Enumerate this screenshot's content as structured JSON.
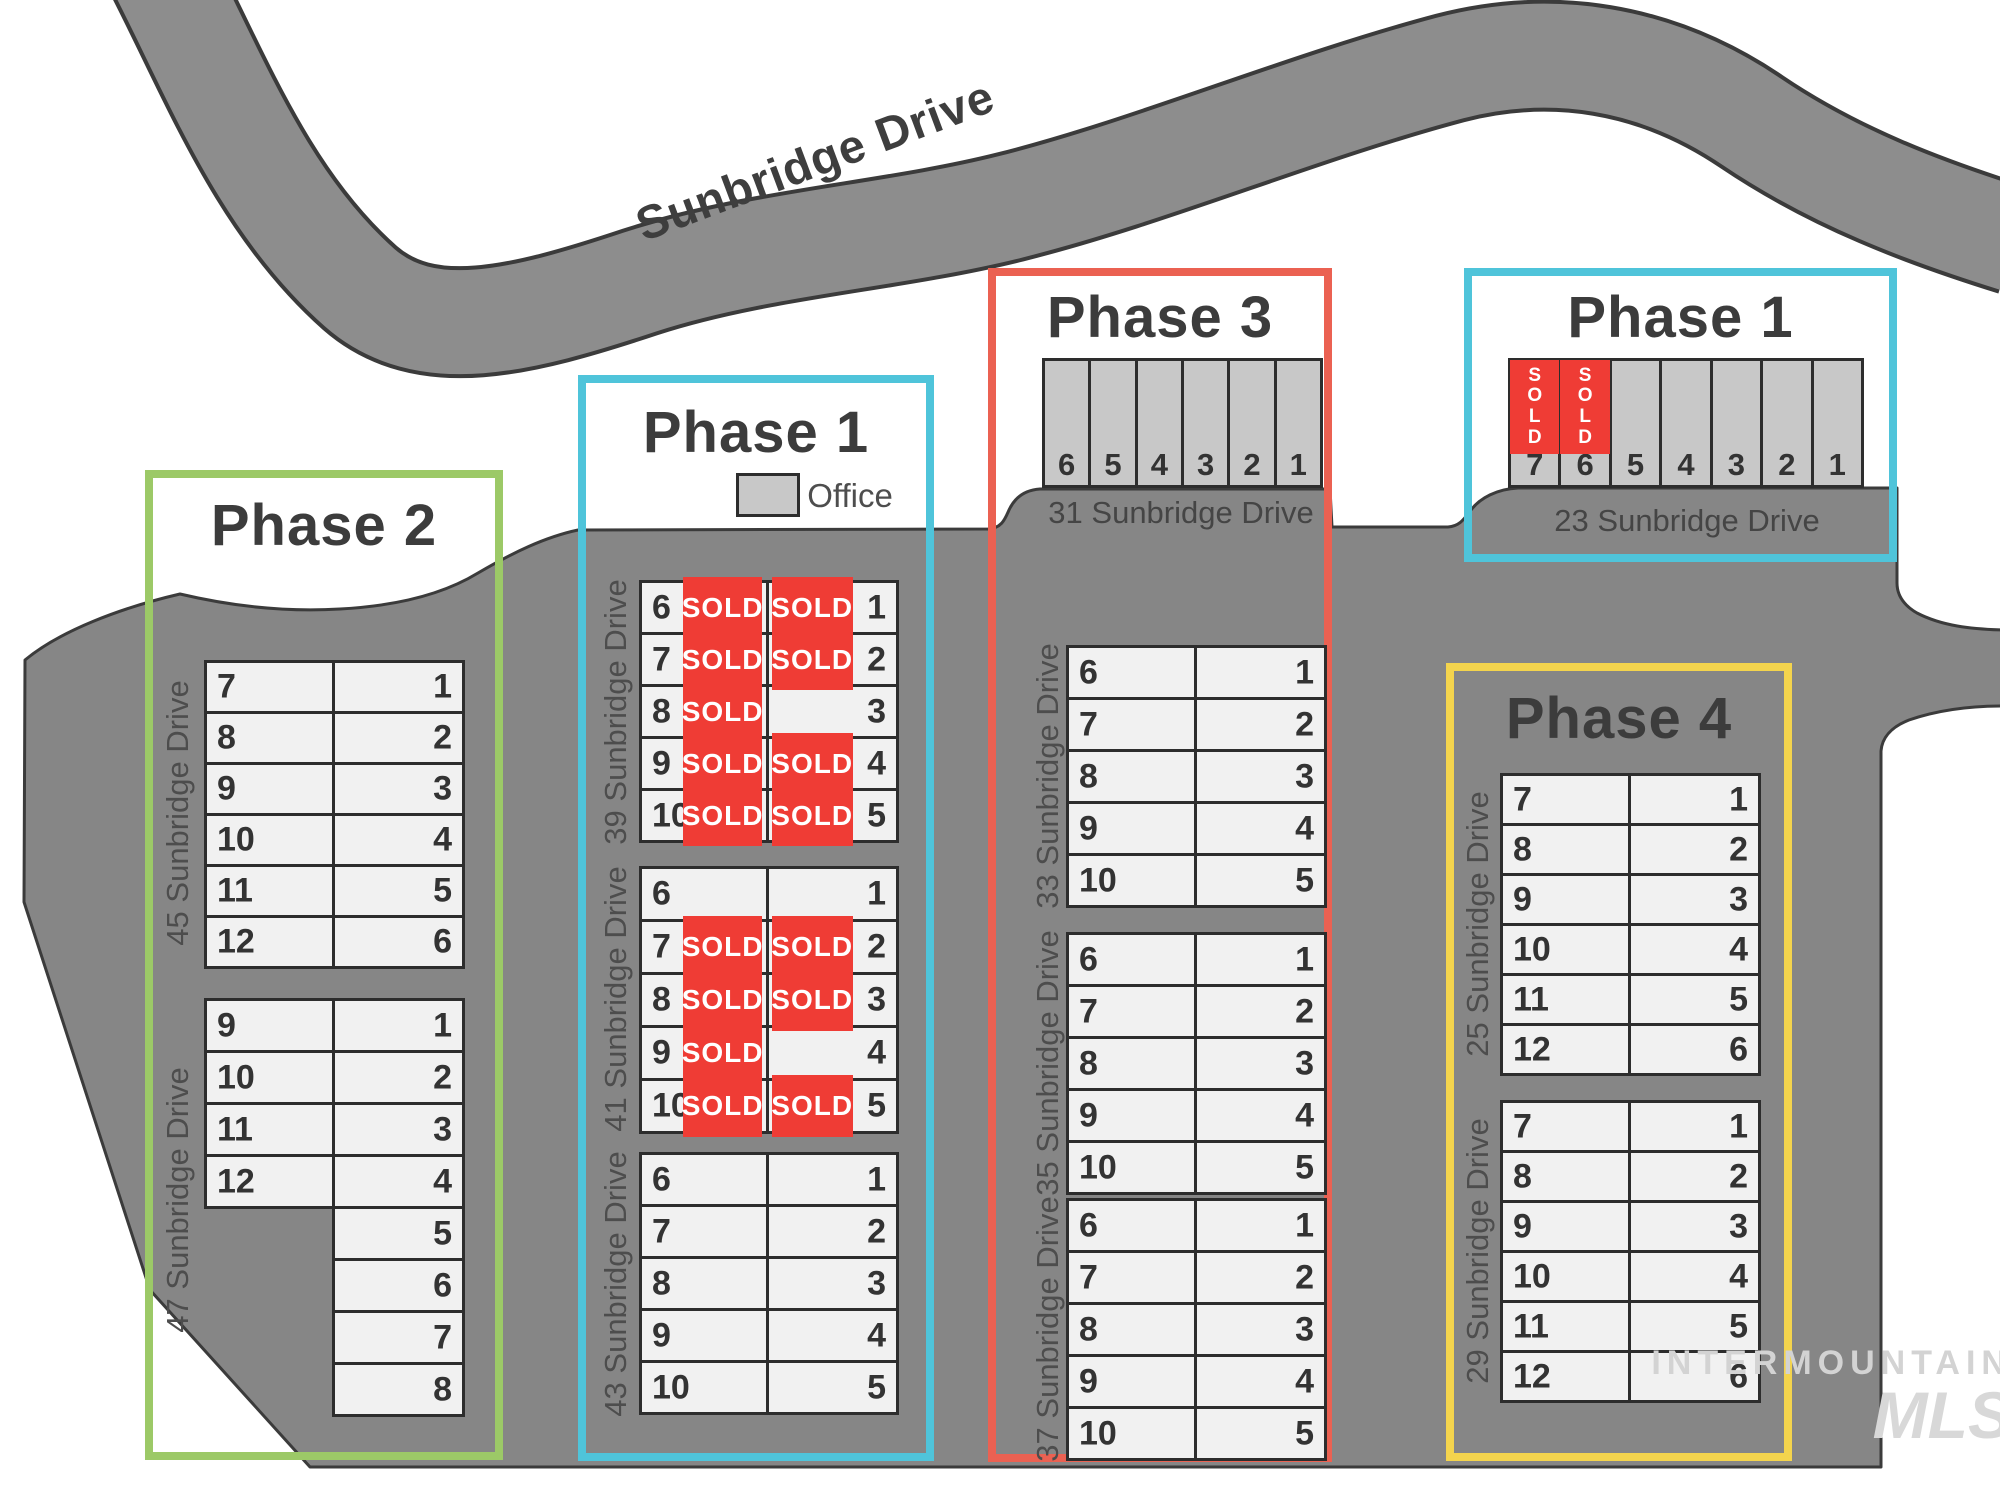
{
  "road": {
    "label": "Sunbridge Drive"
  },
  "legend": {
    "label": "Office"
  },
  "sold_text": "SOLD",
  "watermark": {
    "line1": "INTERMOUNTAIN",
    "line2": "MLS"
  },
  "colors": {
    "parcel": "#868686",
    "road": "#8d8d8d",
    "outline": "#3b3b3b",
    "unit_light": "#f1f1f1",
    "unit_office": "#c8c8c8",
    "sold_red": "#ef3c35",
    "phase1": "#4fc4da",
    "phase2": "#9cc967",
    "phase3": "#eb6152",
    "phase4": "#f4d44d"
  },
  "phases": [
    {
      "id": "phase2",
      "label": "Phase 2",
      "color": "#9cc967"
    },
    {
      "id": "phase1-center",
      "label": "Phase 1",
      "color": "#4fc4da"
    },
    {
      "id": "phase3",
      "label": "Phase 3",
      "color": "#eb6152"
    },
    {
      "id": "phase1-right",
      "label": "Phase 1",
      "color": "#4fc4da"
    },
    {
      "id": "phase4",
      "label": "Phase 4",
      "color": "#f4d44d"
    }
  ],
  "stall_buildings": [
    {
      "id": "b31",
      "address": "31 Sunbridge Drive",
      "units": [
        {
          "n": "6"
        },
        {
          "n": "5"
        },
        {
          "n": "4"
        },
        {
          "n": "3"
        },
        {
          "n": "2"
        },
        {
          "n": "1"
        }
      ]
    },
    {
      "id": "b23",
      "address": "23 Sunbridge Drive",
      "units": [
        {
          "n": "7",
          "sold": true
        },
        {
          "n": "6",
          "sold": true
        },
        {
          "n": "5"
        },
        {
          "n": "4"
        },
        {
          "n": "3"
        },
        {
          "n": "2"
        },
        {
          "n": "1"
        }
      ]
    }
  ],
  "row_buildings": [
    {
      "id": "b45",
      "address": "45 Sunbridge Drive",
      "rows": [
        {
          "l": "7",
          "r": "1"
        },
        {
          "l": "8",
          "r": "2"
        },
        {
          "l": "9",
          "r": "3"
        },
        {
          "l": "10",
          "r": "4"
        },
        {
          "l": "11",
          "r": "5"
        },
        {
          "l": "12",
          "r": "6"
        }
      ]
    },
    {
      "id": "b47",
      "address": "47 Sunbridge Drive",
      "rows": [
        {
          "l": "9",
          "r": "1"
        },
        {
          "l": "10",
          "r": "2"
        },
        {
          "l": "11",
          "r": "3"
        },
        {
          "l": "12",
          "r": "4"
        },
        {
          "r": "5"
        },
        {
          "r": "6"
        },
        {
          "r": "7"
        },
        {
          "r": "8"
        }
      ]
    },
    {
      "id": "b39",
      "address": "39 Sunbridge Drive",
      "rows": [
        {
          "l": "6",
          "ls": true,
          "r": "1",
          "rs": true
        },
        {
          "l": "7",
          "ls": true,
          "r": "2",
          "rs": true
        },
        {
          "l": "8",
          "ls": true,
          "r": "3"
        },
        {
          "l": "9",
          "ls": true,
          "r": "4",
          "rs": true
        },
        {
          "l": "10",
          "ls": true,
          "r": "5",
          "rs": true
        }
      ]
    },
    {
      "id": "b41",
      "address": "41 Sunbridge Drive",
      "rows": [
        {
          "l": "6",
          "r": "1"
        },
        {
          "l": "7",
          "ls": true,
          "r": "2",
          "rs": true
        },
        {
          "l": "8",
          "ls": true,
          "r": "3",
          "rs": true
        },
        {
          "l": "9",
          "ls": true,
          "r": "4"
        },
        {
          "l": "10",
          "ls": true,
          "r": "5",
          "rs": true
        }
      ]
    },
    {
      "id": "b43",
      "address": "43 Sunbridge Drive",
      "rows": [
        {
          "l": "6",
          "r": "1"
        },
        {
          "l": "7",
          "r": "2"
        },
        {
          "l": "8",
          "r": "3"
        },
        {
          "l": "9",
          "r": "4"
        },
        {
          "l": "10",
          "r": "5"
        }
      ]
    },
    {
      "id": "b33",
      "address": "33 Sunbridge Drive",
      "rows": [
        {
          "l": "6",
          "r": "1"
        },
        {
          "l": "7",
          "r": "2"
        },
        {
          "l": "8",
          "r": "3"
        },
        {
          "l": "9",
          "r": "4"
        },
        {
          "l": "10",
          "r": "5"
        }
      ]
    },
    {
      "id": "b35",
      "address": "35 Sunbridge Drive",
      "rows": [
        {
          "l": "6",
          "r": "1"
        },
        {
          "l": "7",
          "r": "2"
        },
        {
          "l": "8",
          "r": "3"
        },
        {
          "l": "9",
          "r": "4"
        },
        {
          "l": "10",
          "r": "5"
        }
      ]
    },
    {
      "id": "b37",
      "address": "37 Sunbridge Drive",
      "rows": [
        {
          "l": "6",
          "r": "1"
        },
        {
          "l": "7",
          "r": "2"
        },
        {
          "l": "8",
          "r": "3"
        },
        {
          "l": "9",
          "r": "4"
        },
        {
          "l": "10",
          "r": "5"
        }
      ]
    },
    {
      "id": "b25",
      "address": "25 Sunbridge Drive",
      "rows": [
        {
          "l": "7",
          "r": "1"
        },
        {
          "l": "8",
          "r": "2"
        },
        {
          "l": "9",
          "r": "3"
        },
        {
          "l": "10",
          "r": "4"
        },
        {
          "l": "11",
          "r": "5"
        },
        {
          "l": "12",
          "r": "6"
        }
      ]
    },
    {
      "id": "b29",
      "address": "29 Sunbridge Drive",
      "rows": [
        {
          "l": "7",
          "r": "1"
        },
        {
          "l": "8",
          "r": "2"
        },
        {
          "l": "9",
          "r": "3"
        },
        {
          "l": "10",
          "r": "4"
        },
        {
          "l": "11",
          "r": "5"
        },
        {
          "l": "12",
          "r": "6"
        }
      ]
    }
  ]
}
